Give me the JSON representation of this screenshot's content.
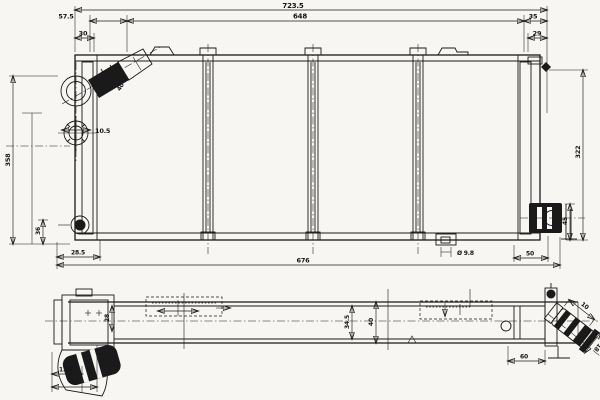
{
  "colors": {
    "ink": "#1a1a1a",
    "paper": "#f7f6f2"
  },
  "dimensions": {
    "front": {
      "overall_width": "723.5",
      "core_width": "648",
      "left_offset": "57.5",
      "left_inset": "30",
      "right_offset": "35",
      "right_inset": "29",
      "overall_height": "358",
      "core_height": "322",
      "tube_offset": "10.5",
      "drain_offset": "36",
      "bottom_left_offset": "28.5",
      "bracket_span": "676",
      "mount_hole": "Ø 9.8",
      "outlet_offset": "50",
      "outlet_height": "45",
      "inlet_dia": "40"
    },
    "side": {
      "hose_offset": "13.5",
      "hose_end": "42",
      "flange_depth": "28",
      "core_thickness": "34.5",
      "overall_thickness": "40",
      "outlet_stub": "10",
      "outlet_end": "18",
      "bracket_width": "60"
    }
  }
}
